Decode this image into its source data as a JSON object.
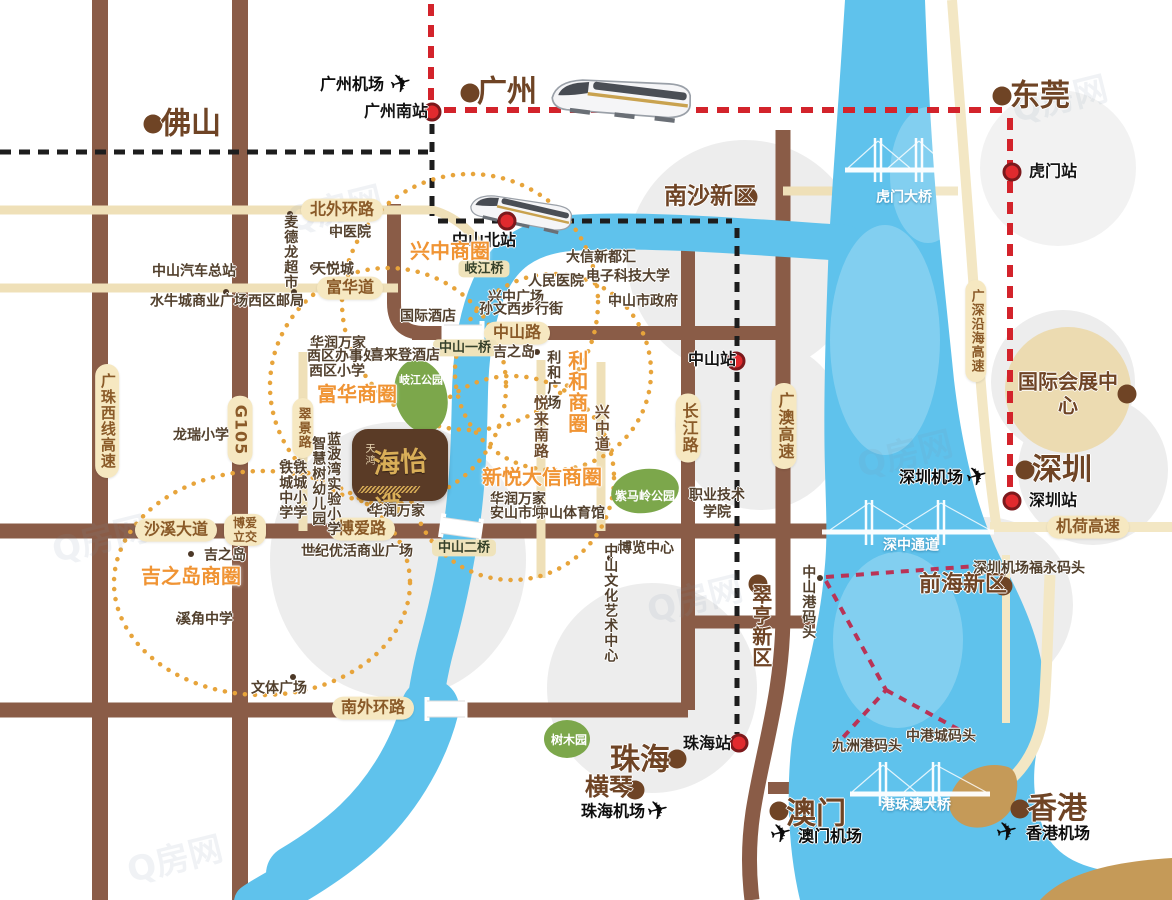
{
  "map": {
    "logo": {
      "prefix": "天鸿",
      "name": "海怡湾"
    },
    "watermark_text": "Q房网",
    "labels": [
      {
        "type": "city",
        "name": "city-foshan",
        "text": "佛山",
        "x": 191,
        "y": 124,
        "size": 30,
        "dot": {
          "x": 153,
          "y": 124
        }
      },
      {
        "type": "city",
        "name": "city-guangzhou",
        "text": "广州",
        "x": 507,
        "y": 92,
        "size": 30,
        "dot": {
          "x": 470,
          "y": 93
        }
      },
      {
        "type": "city",
        "name": "city-dongguan",
        "text": "东莞",
        "x": 1040,
        "y": 96,
        "size": 30,
        "dot": {
          "x": 1002,
          "y": 96
        }
      },
      {
        "type": "city",
        "name": "city-nansha-new-district",
        "text": "南沙新区",
        "x": 710,
        "y": 197,
        "size": 23,
        "dot": {
          "x": 748,
          "y": 197
        }
      },
      {
        "type": "city",
        "name": "city-shenzhen",
        "text": "深圳",
        "x": 1062,
        "y": 470,
        "size": 30,
        "dot": {
          "x": 1025,
          "y": 470
        }
      },
      {
        "type": "city",
        "name": "city-qianhai-new-district",
        "text": "前海新区",
        "x": 963,
        "y": 585,
        "size": 22,
        "dot": {
          "x": 1003,
          "y": 586
        }
      },
      {
        "type": "city",
        "name": "poi-intl-expo-center",
        "text": "国际会展中心",
        "x": 1068,
        "y": 394,
        "size": 20,
        "dot": {
          "x": 1127,
          "y": 394
        }
      },
      {
        "type": "city",
        "name": "city-cuiheng-new-district",
        "text": "翠亨新区",
        "x": 760,
        "y": 626,
        "size": 20,
        "vertical": true,
        "dot": {
          "x": 758,
          "y": 584
        }
      },
      {
        "type": "city",
        "name": "city-zhuhai",
        "text": "珠海",
        "x": 640,
        "y": 760,
        "size": 30,
        "dot": {
          "x": 677,
          "y": 759
        }
      },
      {
        "type": "city",
        "name": "city-hengqin",
        "text": "横琴",
        "x": 609,
        "y": 787,
        "size": 24,
        "dot": {
          "x": 635,
          "y": 790
        }
      },
      {
        "type": "city",
        "name": "city-macau",
        "text": "澳门",
        "x": 816,
        "y": 814,
        "size": 30,
        "dot": {
          "x": 779,
          "y": 811
        }
      },
      {
        "type": "city",
        "name": "city-hongkong",
        "text": "香港",
        "x": 1057,
        "y": 809,
        "size": 30,
        "dot": {
          "x": 1020,
          "y": 809
        }
      },
      {
        "type": "station",
        "name": "station-guangzhou-south",
        "text": "广州南站",
        "x": 396,
        "y": 112,
        "dot": {
          "x": 432,
          "y": 112
        }
      },
      {
        "type": "station",
        "name": "station-zhongshan-north",
        "text": "中山北站",
        "x": 484,
        "y": 241,
        "dot": {
          "x": 507,
          "y": 221
        }
      },
      {
        "type": "station",
        "name": "station-humen",
        "text": "虎门站",
        "x": 1053,
        "y": 172,
        "dot": {
          "x": 1012,
          "y": 172
        }
      },
      {
        "type": "station",
        "name": "station-zhongshan",
        "text": "中山站",
        "x": 712,
        "y": 360,
        "dot": {
          "x": 736,
          "y": 361
        }
      },
      {
        "type": "station",
        "name": "station-shenzhen",
        "text": "深圳站",
        "x": 1053,
        "y": 501,
        "dot": {
          "x": 1012,
          "y": 501
        }
      },
      {
        "type": "station",
        "name": "station-zhuhai",
        "text": "珠海站",
        "x": 707,
        "y": 744,
        "dot": {
          "x": 739,
          "y": 743
        }
      },
      {
        "type": "airport",
        "name": "guangzhou-airport-label",
        "text": "广州机场",
        "x": 352,
        "y": 85
      },
      {
        "type": "airport",
        "name": "shenzhen-airport-label",
        "text": "深圳机场",
        "x": 931,
        "y": 478
      },
      {
        "type": "airport",
        "name": "zhuhai-airport-label",
        "text": "珠海机场",
        "x": 613,
        "y": 812
      },
      {
        "type": "airport",
        "name": "macau-airport-label",
        "text": "澳门机场",
        "x": 830,
        "y": 837
      },
      {
        "type": "airport",
        "name": "hongkong-airport-label",
        "text": "香港机场",
        "x": 1058,
        "y": 834
      },
      {
        "type": "pill",
        "name": "road-north-outer-ring",
        "text": "北外环路",
        "x": 342,
        "y": 210
      },
      {
        "type": "pill",
        "name": "road-fuhua-dao",
        "text": "富华道",
        "x": 350,
        "y": 288
      },
      {
        "type": "pill",
        "name": "road-zhongshan-road",
        "text": "中山路",
        "x": 517,
        "y": 333
      },
      {
        "type": "pill",
        "name": "road-boai-road",
        "text": "博爱路",
        "x": 362,
        "y": 529
      },
      {
        "type": "pill",
        "name": "road-shaxi-avenue",
        "text": "沙溪大道",
        "x": 176,
        "y": 530
      },
      {
        "type": "pill",
        "name": "boai-interchange",
        "text": "博爱\n立交",
        "x": 245,
        "y": 530,
        "size": 12
      },
      {
        "type": "pill",
        "name": "road-south-outer-ring",
        "text": "南外环路",
        "x": 373,
        "y": 708
      },
      {
        "type": "pill",
        "name": "road-changjiang-road",
        "text": "长江路",
        "x": 688,
        "y": 428,
        "vertical": true
      },
      {
        "type": "pill",
        "name": "road-guangao-expressway",
        "text": "广澳高速",
        "x": 784,
        "y": 426,
        "vertical": true
      },
      {
        "type": "pill",
        "name": "road-guangzhu-west-expressway",
        "text": "广珠西线高速",
        "x": 107,
        "y": 421,
        "vertical": true,
        "size": 15
      },
      {
        "type": "pill",
        "name": "road-g105",
        "text": "G105",
        "x": 240,
        "y": 430,
        "vertical": true
      },
      {
        "type": "pill",
        "name": "road-cuijing-road",
        "text": "翠景路",
        "x": 303,
        "y": 428,
        "vertical": true,
        "size": 13
      },
      {
        "type": "pill",
        "name": "road-jihe-expressway",
        "text": "机荷高速",
        "x": 1088,
        "y": 527
      },
      {
        "type": "pill",
        "name": "road-guangshen-coastal-expressway",
        "text": "广深沿海高速",
        "x": 976,
        "y": 331,
        "vertical": true,
        "size": 13
      },
      {
        "type": "bpill",
        "name": "qijiang-bridge-label",
        "text": "岐江桥",
        "x": 484,
        "y": 269
      },
      {
        "type": "bpill",
        "name": "zhongshan-1st-bridge-label",
        "text": "中山一桥",
        "x": 465,
        "y": 348
      },
      {
        "type": "bpill",
        "name": "zhongshan-2nd-bridge-label",
        "text": "中山二桥",
        "x": 464,
        "y": 548
      },
      {
        "type": "biz",
        "name": "xingzhong-business-circle",
        "text": "兴中商圈",
        "x": 450,
        "y": 252
      },
      {
        "type": "biz",
        "name": "fuhua-business-circle",
        "text": "富华商圈",
        "x": 357,
        "y": 395
      },
      {
        "type": "biz",
        "name": "lihe-business-circle",
        "text": "利和商圈",
        "x": 576,
        "y": 392,
        "vertical": true
      },
      {
        "type": "biz",
        "name": "xinyue-daxin-business-circle",
        "text": "新悦大信商圈",
        "x": 542,
        "y": 478
      },
      {
        "type": "biz",
        "name": "jusco-business-circle",
        "text": "吉之岛商圈",
        "x": 191,
        "y": 577
      },
      {
        "type": "wlabel",
        "name": "humen-bridge-label",
        "text": "虎门大桥",
        "x": 904,
        "y": 198
      },
      {
        "type": "wlabel",
        "name": "shenzhong-corridor-label",
        "text": "深中通道",
        "x": 911,
        "y": 546
      },
      {
        "type": "wlabel",
        "name": "hzmb-bridge-label",
        "text": "港珠澳大桥",
        "x": 916,
        "y": 806
      },
      {
        "type": "park",
        "name": "qijiang-park-label",
        "text": "岐江公园",
        "x": 421,
        "y": 381,
        "size": 11
      },
      {
        "type": "park",
        "name": "zimaling-park-label",
        "text": "紫马岭公园",
        "x": 645,
        "y": 496
      },
      {
        "type": "park",
        "name": "arboretum-label",
        "text": "树木园",
        "x": 569,
        "y": 740
      },
      {
        "type": "rname",
        "name": "yuelai-south-road",
        "text": "悦来南路",
        "x": 540,
        "y": 427,
        "vertical": true
      },
      {
        "type": "rname",
        "name": "xingzhong-avenue",
        "text": "兴中道",
        "x": 601,
        "y": 428,
        "vertical": true
      },
      {
        "type": "poi",
        "text": "中山汽车总站",
        "x": 194,
        "y": 272,
        "dot": {
          "x": 226,
          "y": 271
        }
      },
      {
        "type": "poi",
        "text": "水牛城商业广场",
        "x": 199,
        "y": 302,
        "dot": {
          "x": 226,
          "y": 292
        }
      },
      {
        "type": "poi",
        "text": "西区邮局",
        "x": 276,
        "y": 302,
        "dot": {
          "x": 294,
          "y": 292
        }
      },
      {
        "type": "poi",
        "text": "中医院",
        "x": 350,
        "y": 233,
        "dot": {
          "x": 332,
          "y": 232
        }
      },
      {
        "type": "poi",
        "text": "天悦城",
        "x": 333,
        "y": 270,
        "dot": {
          "x": 313,
          "y": 267
        }
      },
      {
        "type": "poi",
        "text": "国际酒店",
        "x": 428,
        "y": 317,
        "dot": {
          "x": 404,
          "y": 315
        }
      },
      {
        "type": "poi",
        "text": "华润万家",
        "x": 338,
        "y": 344,
        "dot": {
          "x": 314,
          "y": 343
        }
      },
      {
        "type": "poi",
        "text": "西区办事处",
        "x": 342,
        "y": 357,
        "dot": {
          "x": 313,
          "y": 356
        }
      },
      {
        "type": "poi",
        "text": "西区小学",
        "x": 337,
        "y": 372,
        "dot": {
          "x": 313,
          "y": 372
        }
      },
      {
        "type": "poi",
        "text": "喜来登酒店",
        "x": 405,
        "y": 356,
        "dot": {
          "x": 433,
          "y": 356
        }
      },
      {
        "type": "poi",
        "text": "龙瑞小学",
        "x": 201,
        "y": 436,
        "dot": {
          "x": 223,
          "y": 434
        }
      },
      {
        "type": "poi",
        "text": "吉之岛",
        "x": 225,
        "y": 556,
        "dot": {
          "x": 191,
          "y": 554
        }
      },
      {
        "type": "poi",
        "text": "溪角中学",
        "x": 205,
        "y": 620,
        "dot": {
          "x": 179,
          "y": 620
        }
      },
      {
        "type": "poi",
        "text": "文体广场",
        "x": 279,
        "y": 689,
        "dot": {
          "x": 293,
          "y": 677
        }
      },
      {
        "type": "poi",
        "text": "世纪优活商业广场",
        "x": 357,
        "y": 552,
        "dot": {
          "x": 313,
          "y": 550
        }
      },
      {
        "type": "poi",
        "text": "华润万家",
        "x": 397,
        "y": 512,
        "dot": {
          "x": 370,
          "y": 510
        }
      },
      {
        "type": "poi",
        "text": "华润万家",
        "x": 518,
        "y": 500,
        "dot": {
          "x": 494,
          "y": 499
        }
      },
      {
        "type": "poi",
        "text": "安山市场",
        "x": 518,
        "y": 514,
        "dot": {
          "x": 494,
          "y": 513
        }
      },
      {
        "type": "poi",
        "text": "中山体育馆",
        "x": 570,
        "y": 514,
        "dot": {
          "x": 600,
          "y": 513
        }
      },
      {
        "type": "poi",
        "text": "兴中广场",
        "x": 516,
        "y": 298,
        "dot": {
          "x": 491,
          "y": 297
        }
      },
      {
        "type": "poi",
        "text": "孙文西步行街",
        "x": 521,
        "y": 310,
        "dot": {
          "x": 486,
          "y": 309
        }
      },
      {
        "type": "poi",
        "text": "人民医院",
        "x": 556,
        "y": 282,
        "dot": {
          "x": 579,
          "y": 282
        }
      },
      {
        "type": "poi",
        "text": "大信新都汇",
        "x": 601,
        "y": 258,
        "dot": {
          "x": 575,
          "y": 257
        }
      },
      {
        "type": "poi",
        "text": "电子科技大学",
        "x": 628,
        "y": 277,
        "dot": {
          "x": 595,
          "y": 277
        }
      },
      {
        "type": "poi",
        "text": "中山市政府",
        "x": 643,
        "y": 302,
        "dot": {
          "x": 614,
          "y": 302
        }
      },
      {
        "type": "poi",
        "text": "吉之岛",
        "x": 514,
        "y": 353,
        "dot": {
          "x": 537,
          "y": 352
        }
      },
      {
        "type": "poi",
        "text": "博览中心",
        "x": 646,
        "y": 549,
        "dot": {
          "x": 619,
          "y": 548
        }
      },
      {
        "type": "poi",
        "text": "职业技术\n学院",
        "x": 717,
        "y": 504
      },
      {
        "type": "poi",
        "text": "深圳机场福永码头",
        "x": 1029,
        "y": 569,
        "dot": {
          "x": 985,
          "y": 568
        }
      },
      {
        "type": "poi",
        "text": "九洲港码头",
        "x": 867,
        "y": 747,
        "dot": {
          "x": 836,
          "y": 747
        }
      },
      {
        "type": "poi",
        "text": "中港城码头",
        "x": 941,
        "y": 737,
        "dot": {
          "x": 971,
          "y": 737
        }
      },
      {
        "type": "poi",
        "text": "麦德龙超市",
        "x": 290,
        "y": 252,
        "vertical": true,
        "dot": {
          "x": 290,
          "y": 214
        }
      },
      {
        "type": "poi",
        "text": "铁城中学",
        "x": 285,
        "y": 490,
        "vertical": true,
        "dot": {
          "x": 285,
          "y": 462
        }
      },
      {
        "type": "poi",
        "text": "铁城小学",
        "x": 299,
        "y": 490,
        "vertical": true,
        "dot": {
          "x": 299,
          "y": 462
        }
      },
      {
        "type": "poi",
        "text": "智慧树幼儿园",
        "x": 318,
        "y": 481,
        "vertical": true,
        "dot": {
          "x": 318,
          "y": 445
        }
      },
      {
        "type": "poi",
        "text": "蓝波湾实验小学",
        "x": 333,
        "y": 484,
        "vertical": true,
        "dot": {
          "x": 333,
          "y": 447
        }
      },
      {
        "type": "poi",
        "text": "利和广场",
        "x": 553,
        "y": 380,
        "vertical": true,
        "dot": {
          "x": 553,
          "y": 355
        }
      },
      {
        "type": "poi",
        "name": "zhongshan-port-pier",
        "text": "中山港码头",
        "x": 808,
        "y": 602,
        "vertical": true,
        "dot": {
          "x": 820,
          "y": 578
        }
      },
      {
        "type": "poi",
        "text": "中山文化艺术中心",
        "x": 610,
        "y": 603,
        "vertical": true,
        "dot": {
          "x": 610,
          "y": 558
        }
      },
      {
        "type": "wm",
        "name": "watermark",
        "text": "Q房网",
        "x": 100,
        "y": 540
      },
      {
        "type": "wm",
        "name": "watermark",
        "text": "Q房网",
        "x": 335,
        "y": 210
      },
      {
        "type": "wm",
        "name": "watermark",
        "text": "Q房网",
        "x": 695,
        "y": 600
      },
      {
        "type": "wm",
        "name": "watermark",
        "text": "Q房网",
        "x": 905,
        "y": 455
      },
      {
        "type": "wm",
        "name": "watermark",
        "text": "Q房网",
        "x": 1060,
        "y": 100
      },
      {
        "type": "wm",
        "name": "watermark",
        "text": "Q房网",
        "x": 175,
        "y": 860
      }
    ],
    "planes": [
      {
        "name": "guangzhou-airport-plane",
        "x": 401,
        "y": 84,
        "rot": -16
      },
      {
        "name": "shenzhen-airport-plane",
        "x": 977,
        "y": 477,
        "rot": -16
      },
      {
        "name": "zhuhai-airport-plane",
        "x": 658,
        "y": 811,
        "rot": -14
      },
      {
        "name": "macau-airport-plane",
        "x": 781,
        "y": 834,
        "rot": -14
      },
      {
        "name": "hongkong-airport-plane",
        "x": 1007,
        "y": 832,
        "rot": -14
      }
    ]
  }
}
